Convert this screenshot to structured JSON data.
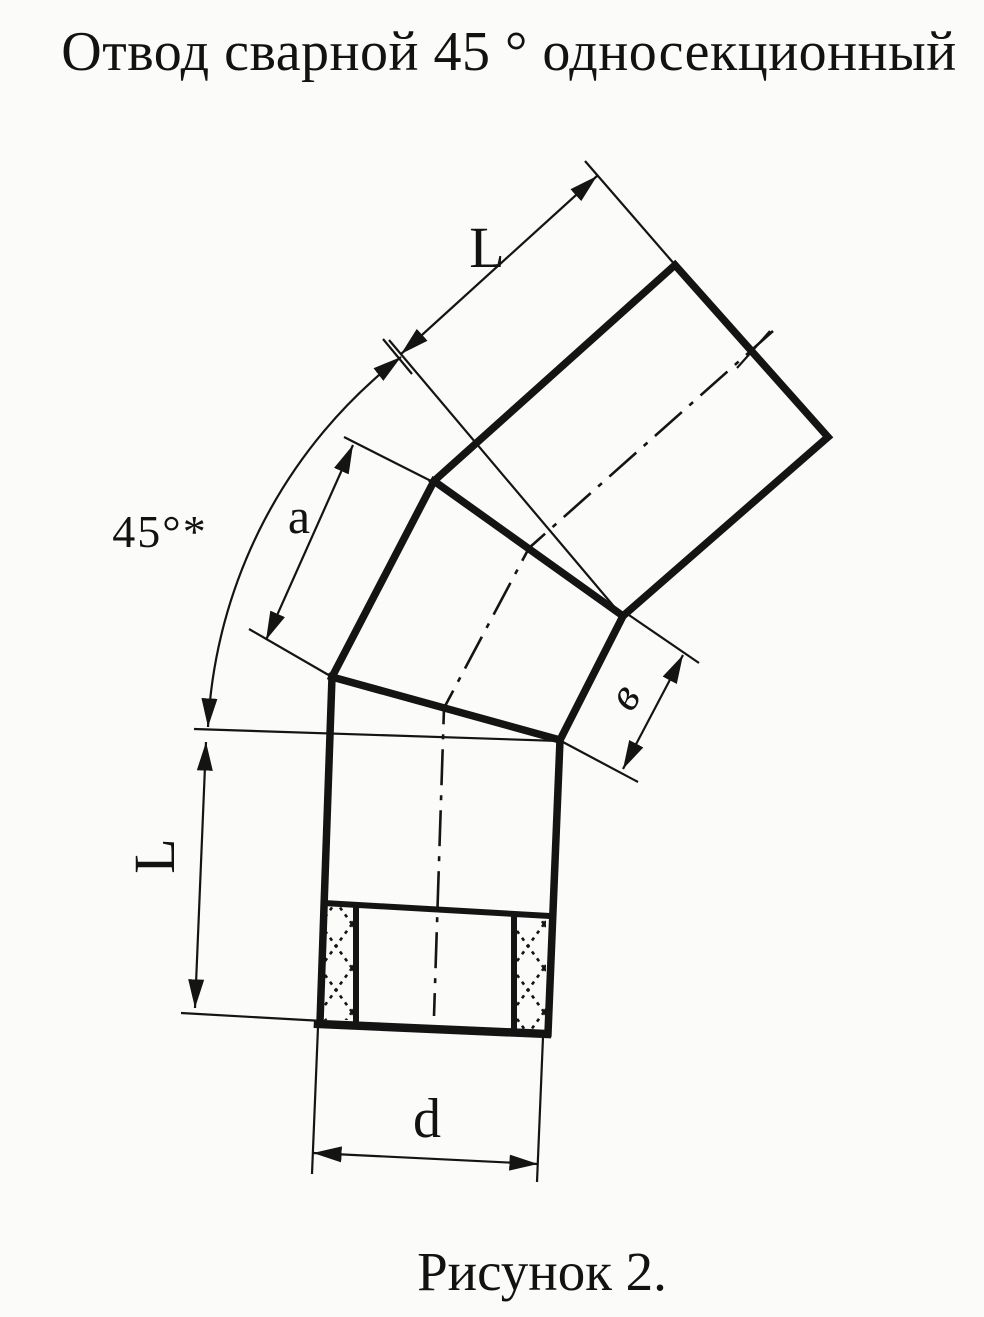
{
  "page": {
    "title": "Отвод сварной 45 ° односекционный",
    "caption": "Рисунок 2.",
    "ink_color": "#141414",
    "paper_color": "#fbfbf9"
  },
  "labels": {
    "top_length": "L",
    "angle": "45°*",
    "section_a": "a",
    "side_width": "в",
    "left_length": "L",
    "diameter": "d"
  }
}
